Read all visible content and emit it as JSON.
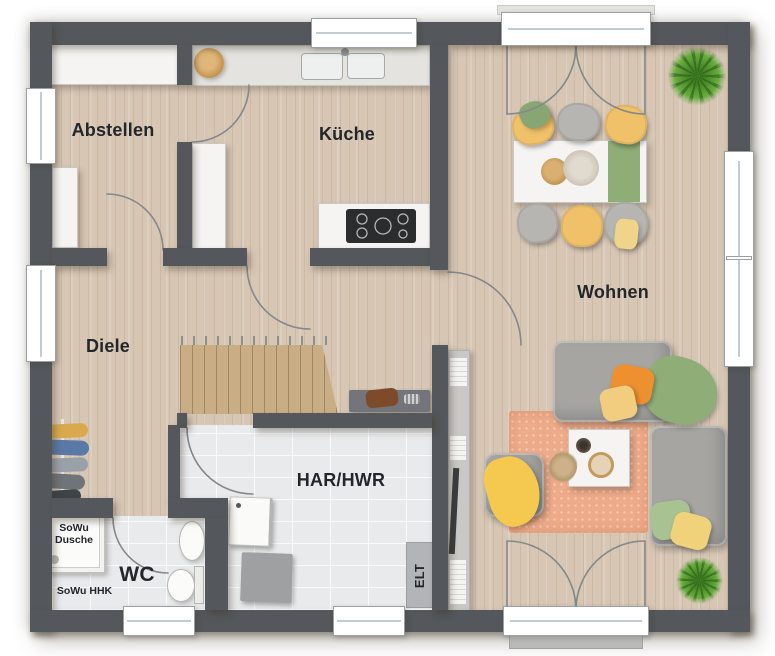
{
  "rooms": {
    "abstellen": {
      "label": "Abstellen"
    },
    "kueche": {
      "label": "Küche"
    },
    "wohnen": {
      "label": "Wohnen"
    },
    "diele": {
      "label": "Diele"
    },
    "har_hwr": {
      "label": "HAR/HWR"
    },
    "wc": {
      "label": "WC"
    }
  },
  "annotations": {
    "shower": {
      "label": "SoWu Dusche"
    },
    "hhk": {
      "label": "SoWu HHK"
    },
    "elt": {
      "label": "ELT"
    }
  },
  "colors": {
    "wall": "#54575b",
    "floor_wood": "#d7c6b4",
    "floor_tile": "#e9eaec",
    "stairs_wood": "#c9ad85",
    "rug": "#eeab89",
    "sofa_gray": "#a6a5a2",
    "chair_yellow": "#f0c168",
    "pillow_orange": "#ef9030",
    "textile_green": "#8fae77",
    "plant_green": "#63a83a",
    "furniture_white": "#f5f4f2",
    "door_arc": "#85888b",
    "label_text": "#23262b"
  }
}
